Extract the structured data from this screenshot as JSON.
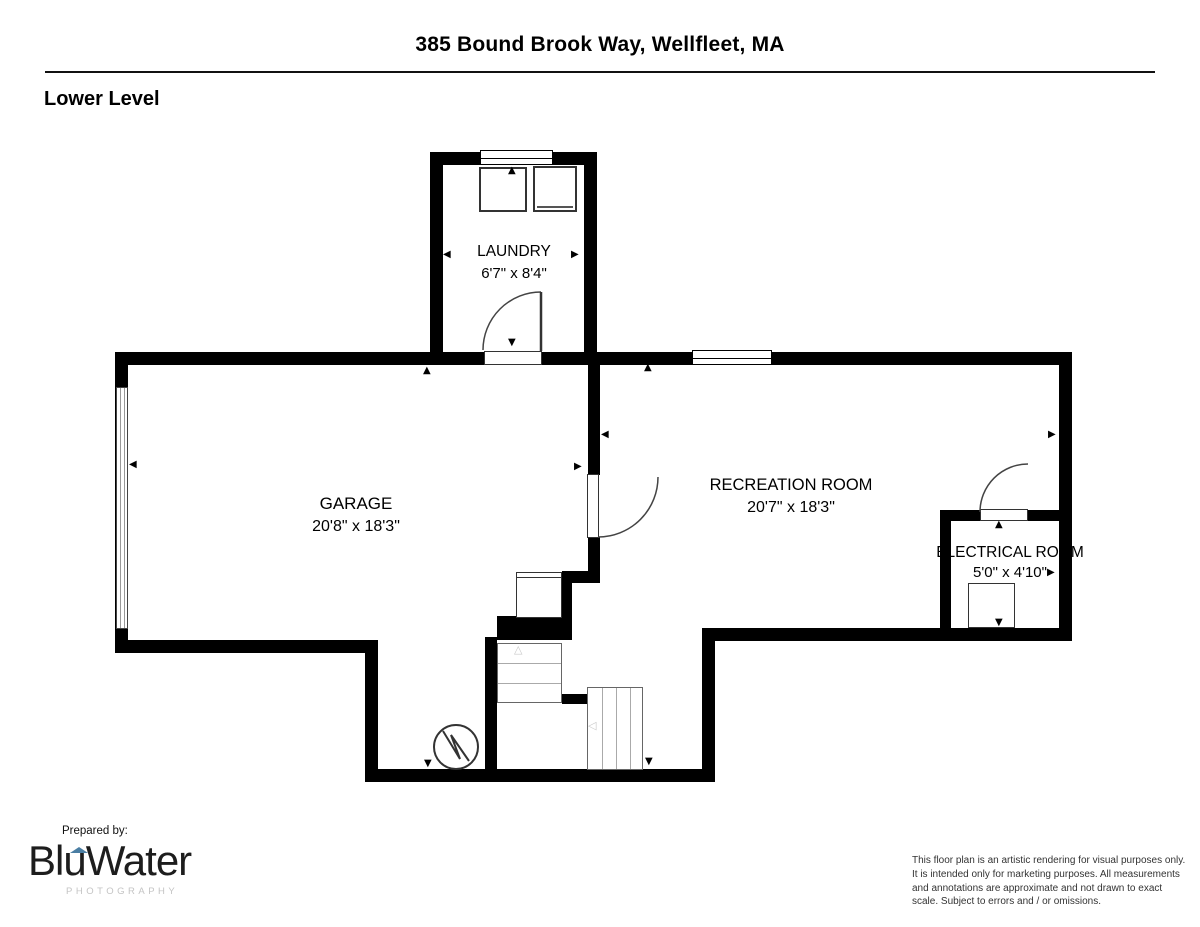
{
  "header": {
    "address": "385 Bound Brook Way, Wellfleet, MA",
    "level_label": "Lower Level"
  },
  "rooms": {
    "laundry": {
      "name": "LAUNDRY",
      "dims": "6'7\" x 8'4\""
    },
    "garage": {
      "name": "GARAGE",
      "dims": "20'8\" x 18'3\""
    },
    "recreation": {
      "name": "RECREATION ROOM",
      "dims": "20'7\" x 18'3\""
    },
    "electrical": {
      "name": "ELECTRICAL ROOM",
      "dims": "5'0\" x 4'10\""
    }
  },
  "icons": {
    "arrow_up": "▲",
    "arrow_down": "▼",
    "arrow_left": "◀",
    "arrow_right": "▶",
    "stair_up_outline": "△",
    "stair_left_outline": "◁"
  },
  "footer": {
    "prepared_by": "Prepared by:",
    "brand_name": "BluWater",
    "brand_subtitle": "PHOTOGRAPHY",
    "disclaimer": "This floor plan is an artistic rendering for visual purposes only. It is intended only for marketing purposes. All measurements and annotations are approximate and not drawn to exact scale. Subject to errors and / or omissions."
  },
  "colors": {
    "wall": "#000000",
    "brand_accent": "#4a7ea3",
    "subtitle_gray": "#c4c4c4"
  }
}
